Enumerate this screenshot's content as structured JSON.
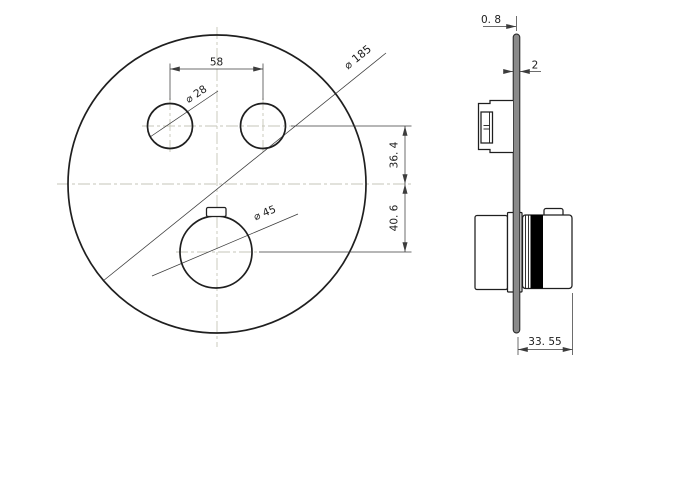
{
  "drawing": {
    "front_view": {
      "hole_spacing": "58",
      "button_hole_diameter": "⌀ 28",
      "plate_diameter": "⌀ 185",
      "knob_diameter": "⌀ 45",
      "buttons_to_centerline": "36. 4",
      "centerline_to_knob": "40. 6"
    },
    "side_view": {
      "edge_thickness": "0. 8",
      "plate_thickness": "2",
      "projection_depth": "33. 55"
    },
    "colors": {
      "object_line": "#1f1f1f",
      "dimension_line": "#3c3c3c",
      "centerline": "#c6c6b8",
      "plate_fill": "#8a8a8a",
      "band_fill": "#000000",
      "background": "#ffffff"
    }
  }
}
